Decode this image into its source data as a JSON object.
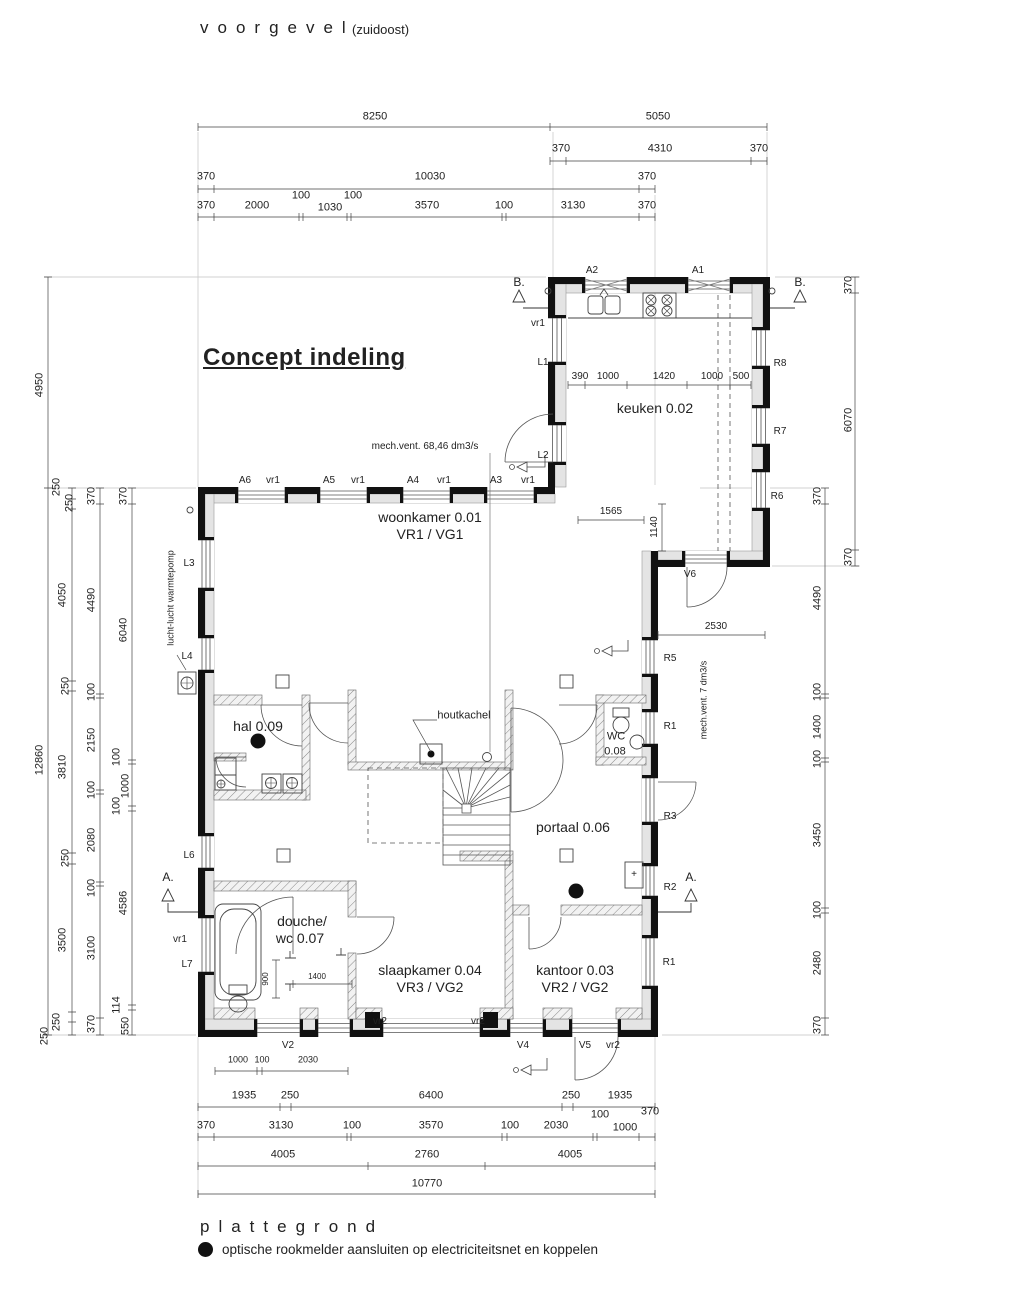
{
  "header": {
    "facade_title": "voorgevel",
    "facade_subtitle": "(zuidoost)",
    "concept_title": "Concept indeling"
  },
  "footer": {
    "plan_title": "plattegrond",
    "legend_text": "optische rookmelder aansluiten op electriciteitsnet en koppelen"
  },
  "colors": {
    "line": "#1a1a1a",
    "wall_black": "#111111",
    "wall_gray": "#e4e4e4",
    "dim": "#444444"
  },
  "labels": [
    {
      "t": "8250",
      "x": 375,
      "y": 117,
      "n": "dim-label"
    },
    {
      "t": "5050",
      "x": 658,
      "y": 117,
      "n": "dim-label"
    },
    {
      "t": "370",
      "x": 561,
      "y": 149,
      "n": "dim-label"
    },
    {
      "t": "4310",
      "x": 660,
      "y": 149,
      "n": "dim-label"
    },
    {
      "t": "370",
      "x": 759,
      "y": 149,
      "n": "dim-label"
    },
    {
      "t": "370",
      "x": 206,
      "y": 177,
      "n": "dim-label"
    },
    {
      "t": "10030",
      "x": 430,
      "y": 177,
      "n": "dim-label"
    },
    {
      "t": "370",
      "x": 647,
      "y": 177,
      "n": "dim-label"
    },
    {
      "t": "370",
      "x": 206,
      "y": 206,
      "n": "dim-label"
    },
    {
      "t": "2000",
      "x": 257,
      "y": 206,
      "n": "dim-label"
    },
    {
      "t": "100",
      "x": 301,
      "y": 196,
      "n": "dim-label"
    },
    {
      "t": "1030",
      "x": 330,
      "y": 208,
      "n": "dim-label"
    },
    {
      "t": "100",
      "x": 353,
      "y": 196,
      "n": "dim-label"
    },
    {
      "t": "3570",
      "x": 427,
      "y": 206,
      "n": "dim-label"
    },
    {
      "t": "100",
      "x": 504,
      "y": 206,
      "n": "dim-label"
    },
    {
      "t": "3130",
      "x": 573,
      "y": 206,
      "n": "dim-label"
    },
    {
      "t": "370",
      "x": 647,
      "y": 206,
      "n": "dim-label"
    },
    {
      "t": "1935",
      "x": 244,
      "y": 1096,
      "n": "dim-label"
    },
    {
      "t": "250",
      "x": 290,
      "y": 1096,
      "n": "dim-label"
    },
    {
      "t": "6400",
      "x": 431,
      "y": 1096,
      "n": "dim-label"
    },
    {
      "t": "250",
      "x": 571,
      "y": 1096,
      "n": "dim-label"
    },
    {
      "t": "1935",
      "x": 620,
      "y": 1096,
      "n": "dim-label"
    },
    {
      "t": "370",
      "x": 206,
      "y": 1126,
      "n": "dim-label"
    },
    {
      "t": "3130",
      "x": 281,
      "y": 1126,
      "n": "dim-label"
    },
    {
      "t": "100",
      "x": 352,
      "y": 1126,
      "n": "dim-label"
    },
    {
      "t": "3570",
      "x": 431,
      "y": 1126,
      "n": "dim-label"
    },
    {
      "t": "100",
      "x": 510,
      "y": 1126,
      "n": "dim-label"
    },
    {
      "t": "2030",
      "x": 556,
      "y": 1126,
      "n": "dim-label"
    },
    {
      "t": "100",
      "x": 600,
      "y": 1115,
      "n": "dim-label"
    },
    {
      "t": "1000",
      "x": 625,
      "y": 1128,
      "n": "dim-label"
    },
    {
      "t": "370",
      "x": 650,
      "y": 1112,
      "n": "dim-label"
    },
    {
      "t": "4005",
      "x": 283,
      "y": 1155,
      "n": "dim-label"
    },
    {
      "t": "2760",
      "x": 427,
      "y": 1155,
      "n": "dim-label"
    },
    {
      "t": "4005",
      "x": 570,
      "y": 1155,
      "n": "dim-label"
    },
    {
      "t": "10770",
      "x": 427,
      "y": 1184,
      "n": "dim-label"
    },
    {
      "t": "1000",
      "x": 238,
      "y": 1060,
      "s": 9,
      "n": "dim-label"
    },
    {
      "t": "100",
      "x": 262,
      "y": 1060,
      "s": 9,
      "n": "dim-label"
    },
    {
      "t": "2030",
      "x": 308,
      "y": 1060,
      "s": 9,
      "n": "dim-label"
    },
    {
      "t": "4950",
      "x": 40,
      "y": 385,
      "r": 1,
      "n": "dim-label"
    },
    {
      "t": "12860",
      "x": 40,
      "y": 760,
      "r": 1,
      "n": "dim-label"
    },
    {
      "t": "250",
      "x": 57,
      "y": 487,
      "r": 1,
      "n": "dim-label"
    },
    {
      "t": "250",
      "x": 70,
      "y": 503,
      "r": 1,
      "n": "dim-label"
    },
    {
      "t": "4050",
      "x": 63,
      "y": 595,
      "r": 1,
      "n": "dim-label"
    },
    {
      "t": "250",
      "x": 66,
      "y": 686,
      "r": 1,
      "n": "dim-label"
    },
    {
      "t": "3810",
      "x": 63,
      "y": 767,
      "r": 1,
      "n": "dim-label"
    },
    {
      "t": "250",
      "x": 66,
      "y": 858,
      "r": 1,
      "n": "dim-label"
    },
    {
      "t": "3500",
      "x": 63,
      "y": 940,
      "r": 1,
      "n": "dim-label"
    },
    {
      "t": "250",
      "x": 57,
      "y": 1022,
      "r": 1,
      "n": "dim-label"
    },
    {
      "t": "250",
      "x": 45,
      "y": 1036,
      "r": 1,
      "n": "dim-label"
    },
    {
      "t": "370",
      "x": 92,
      "y": 496,
      "r": 1,
      "n": "dim-label"
    },
    {
      "t": "4490",
      "x": 92,
      "y": 600,
      "r": 1,
      "n": "dim-label"
    },
    {
      "t": "100",
      "x": 92,
      "y": 692,
      "r": 1,
      "n": "dim-label"
    },
    {
      "t": "2150",
      "x": 92,
      "y": 740,
      "r": 1,
      "n": "dim-label"
    },
    {
      "t": "100",
      "x": 92,
      "y": 790,
      "r": 1,
      "n": "dim-label"
    },
    {
      "t": "2080",
      "x": 92,
      "y": 840,
      "r": 1,
      "n": "dim-label"
    },
    {
      "t": "100",
      "x": 92,
      "y": 888,
      "r": 1,
      "n": "dim-label"
    },
    {
      "t": "3100",
      "x": 92,
      "y": 948,
      "r": 1,
      "n": "dim-label"
    },
    {
      "t": "370",
      "x": 92,
      "y": 1024,
      "r": 1,
      "n": "dim-label"
    },
    {
      "t": "370",
      "x": 124,
      "y": 496,
      "r": 1,
      "n": "dim-label"
    },
    {
      "t": "6040",
      "x": 124,
      "y": 630,
      "r": 1,
      "n": "dim-label"
    },
    {
      "t": "100",
      "x": 117,
      "y": 757,
      "r": 1,
      "n": "dim-label"
    },
    {
      "t": "1000",
      "x": 126,
      "y": 786,
      "r": 1,
      "n": "dim-label"
    },
    {
      "t": "100",
      "x": 117,
      "y": 806,
      "r": 1,
      "n": "dim-label"
    },
    {
      "t": "4586",
      "x": 124,
      "y": 903,
      "r": 1,
      "n": "dim-label"
    },
    {
      "t": "114",
      "x": 117,
      "y": 1005,
      "r": 1,
      "n": "dim-label"
    },
    {
      "t": "550",
      "x": 126,
      "y": 1026,
      "r": 1,
      "n": "dim-label"
    },
    {
      "t": "370",
      "x": 818,
      "y": 496,
      "r": 1,
      "n": "dim-label"
    },
    {
      "t": "4490",
      "x": 818,
      "y": 598,
      "r": 1,
      "n": "dim-label"
    },
    {
      "t": "100",
      "x": 818,
      "y": 692,
      "r": 1,
      "n": "dim-label"
    },
    {
      "t": "1400",
      "x": 818,
      "y": 727,
      "r": 1,
      "n": "dim-label"
    },
    {
      "t": "100",
      "x": 818,
      "y": 759,
      "r": 1,
      "n": "dim-label"
    },
    {
      "t": "3450",
      "x": 818,
      "y": 835,
      "r": 1,
      "n": "dim-label"
    },
    {
      "t": "100",
      "x": 818,
      "y": 910,
      "r": 1,
      "n": "dim-label"
    },
    {
      "t": "2480",
      "x": 818,
      "y": 963,
      "r": 1,
      "n": "dim-label"
    },
    {
      "t": "370",
      "x": 818,
      "y": 1025,
      "r": 1,
      "n": "dim-label"
    },
    {
      "t": "370",
      "x": 849,
      "y": 285,
      "r": 1,
      "n": "dim-label"
    },
    {
      "t": "6070",
      "x": 849,
      "y": 420,
      "r": 1,
      "n": "dim-label"
    },
    {
      "t": "370",
      "x": 849,
      "y": 557,
      "r": 1,
      "n": "dim-label"
    },
    {
      "t": "390",
      "x": 580,
      "y": 377,
      "s": 10,
      "n": "dim-label"
    },
    {
      "t": "1000",
      "x": 608,
      "y": 377,
      "s": 10,
      "n": "dim-label"
    },
    {
      "t": "1420",
      "x": 664,
      "y": 377,
      "s": 10,
      "n": "dim-label"
    },
    {
      "t": "1000",
      "x": 712,
      "y": 377,
      "s": 10,
      "n": "dim-label"
    },
    {
      "t": "500",
      "x": 741,
      "y": 377,
      "s": 10,
      "n": "dim-label"
    },
    {
      "t": "1565",
      "x": 611,
      "y": 512,
      "s": 10,
      "n": "dim-label"
    },
    {
      "t": "1140",
      "x": 655,
      "y": 527,
      "s": 10,
      "r": 1,
      "n": "dim-label"
    },
    {
      "t": "2530",
      "x": 716,
      "y": 627,
      "s": 10,
      "n": "dim-label"
    },
    {
      "t": "1400",
      "x": 317,
      "y": 977,
      "s": 8,
      "n": "dim-label"
    },
    {
      "t": "900",
      "x": 266,
      "y": 979,
      "s": 8,
      "r": 1,
      "n": "dim-label"
    },
    {
      "t": "mech.vent. 68,46 dm3/s",
      "x": 425,
      "y": 447,
      "s": 10,
      "n": "annotation-mech-vent"
    },
    {
      "t": "mech.vent. 7 dm3/s",
      "x": 704,
      "y": 700,
      "s": 9,
      "r": 1,
      "n": "annotation-mech-vent"
    },
    {
      "t": "lucht-lucht warmtepomp",
      "x": 171,
      "y": 598,
      "s": 9,
      "r": 1,
      "n": "annotation-heatpump"
    },
    {
      "t": "houtkachel",
      "x": 464,
      "y": 716,
      "s": 11,
      "n": "annotation-houtkachel"
    },
    {
      "t": "keuken 0.02",
      "x": 655,
      "y": 408,
      "s": 14,
      "n": "room-label-keuken"
    },
    {
      "t": "woonkamer 0.01",
      "x": 430,
      "y": 517,
      "s": 14,
      "n": "room-label-woonkamer"
    },
    {
      "t": "VR1 / VG1",
      "x": 430,
      "y": 534,
      "s": 14,
      "n": "room-label-woonkamer-sub"
    },
    {
      "t": "hal 0.09",
      "x": 258,
      "y": 726,
      "s": 14,
      "n": "room-label-hal"
    },
    {
      "t": "WC",
      "x": 616,
      "y": 737,
      "s": 11,
      "n": "room-label-wc"
    },
    {
      "t": "0.08",
      "x": 615,
      "y": 752,
      "s": 11,
      "n": "room-label-wc-sub"
    },
    {
      "t": "portaal 0.06",
      "x": 573,
      "y": 827,
      "s": 14,
      "n": "room-label-portaal"
    },
    {
      "t": "douche/",
      "x": 302,
      "y": 921,
      "s": 14,
      "n": "room-label-douche"
    },
    {
      "t": "wc 0.07",
      "x": 300,
      "y": 938,
      "s": 14,
      "n": "room-label-douche-sub"
    },
    {
      "t": "slaapkamer 0.04",
      "x": 430,
      "y": 970,
      "s": 14,
      "n": "room-label-slaapkamer"
    },
    {
      "t": "VR3 / VG2",
      "x": 430,
      "y": 987,
      "s": 14,
      "n": "room-label-slaapkamer-sub"
    },
    {
      "t": "kantoor 0.03",
      "x": 575,
      "y": 970,
      "s": 14,
      "n": "room-label-kantoor"
    },
    {
      "t": "VR2 / VG2",
      "x": 575,
      "y": 987,
      "s": 14,
      "n": "room-label-kantoor-sub"
    },
    {
      "t": "A2",
      "x": 592,
      "y": 271,
      "s": 10,
      "n": "window-label"
    },
    {
      "t": "A1",
      "x": 698,
      "y": 271,
      "s": 10,
      "n": "window-label"
    },
    {
      "t": "A6",
      "x": 245,
      "y": 481,
      "s": 10,
      "n": "window-label"
    },
    {
      "t": "vr1",
      "x": 273,
      "y": 481,
      "s": 10,
      "n": "vent-label"
    },
    {
      "t": "A5",
      "x": 329,
      "y": 481,
      "s": 10,
      "n": "window-label"
    },
    {
      "t": "vr1",
      "x": 358,
      "y": 481,
      "s": 10,
      "n": "vent-label"
    },
    {
      "t": "A4",
      "x": 413,
      "y": 481,
      "s": 10,
      "n": "window-label"
    },
    {
      "t": "vr1",
      "x": 444,
      "y": 481,
      "s": 10,
      "n": "vent-label"
    },
    {
      "t": "A3",
      "x": 496,
      "y": 481,
      "s": 10,
      "n": "window-label"
    },
    {
      "t": "vr1",
      "x": 528,
      "y": 481,
      "s": 10,
      "n": "vent-label"
    },
    {
      "t": "vr1",
      "x": 538,
      "y": 324,
      "s": 10,
      "n": "vent-label"
    },
    {
      "t": "L1",
      "x": 543,
      "y": 363,
      "s": 10,
      "n": "window-label"
    },
    {
      "t": "L2",
      "x": 543,
      "y": 456,
      "s": 10,
      "n": "window-label"
    },
    {
      "t": "L3",
      "x": 189,
      "y": 564,
      "s": 10,
      "n": "window-label"
    },
    {
      "t": "L4",
      "x": 187,
      "y": 657,
      "s": 10,
      "n": "window-label"
    },
    {
      "t": "L6",
      "x": 189,
      "y": 856,
      "s": 10,
      "n": "window-label"
    },
    {
      "t": "vr1",
      "x": 180,
      "y": 940,
      "s": 10,
      "n": "vent-label"
    },
    {
      "t": "L7",
      "x": 187,
      "y": 965,
      "s": 10,
      "n": "window-label"
    },
    {
      "t": "R8",
      "x": 780,
      "y": 364,
      "s": 10,
      "n": "window-label"
    },
    {
      "t": "R7",
      "x": 780,
      "y": 432,
      "s": 10,
      "n": "window-label"
    },
    {
      "t": "R6",
      "x": 777,
      "y": 497,
      "s": 10,
      "n": "window-label"
    },
    {
      "t": "R5",
      "x": 670,
      "y": 659,
      "s": 10,
      "n": "window-label"
    },
    {
      "t": "R1",
      "x": 670,
      "y": 727,
      "s": 10,
      "n": "window-label"
    },
    {
      "t": "R3",
      "x": 670,
      "y": 817,
      "s": 10,
      "n": "window-label"
    },
    {
      "t": "R2",
      "x": 670,
      "y": 888,
      "s": 10,
      "n": "window-label"
    },
    {
      "t": "R1",
      "x": 669,
      "y": 963,
      "s": 10,
      "n": "window-label"
    },
    {
      "t": "V6",
      "x": 690,
      "y": 575,
      "s": 10,
      "n": "window-label"
    },
    {
      "t": "V2",
      "x": 288,
      "y": 1046,
      "s": 10,
      "n": "window-label"
    },
    {
      "t": "V4",
      "x": 523,
      "y": 1046,
      "s": 10,
      "n": "window-label"
    },
    {
      "t": "V5",
      "x": 585,
      "y": 1046,
      "s": 10,
      "n": "window-label"
    },
    {
      "t": "vr2",
      "x": 613,
      "y": 1046,
      "s": 10,
      "n": "vent-label"
    },
    {
      "t": "vr2",
      "x": 380,
      "y": 1022,
      "s": 10,
      "n": "vent-label"
    },
    {
      "t": "vr2",
      "x": 478,
      "y": 1022,
      "s": 10,
      "n": "vent-label"
    },
    {
      "t": "B.",
      "x": 519,
      "y": 282,
      "s": 12,
      "n": "section-marker-label"
    },
    {
      "t": "B.",
      "x": 800,
      "y": 282,
      "s": 12,
      "n": "section-marker-label"
    },
    {
      "t": "A.",
      "x": 168,
      "y": 877,
      "s": 12,
      "n": "section-marker-label"
    },
    {
      "t": "A.",
      "x": 691,
      "y": 877,
      "s": 12,
      "n": "section-marker-label"
    },
    {
      "t": "+",
      "x": 634,
      "y": 875,
      "s": 10,
      "n": "plus-box-label"
    }
  ]
}
